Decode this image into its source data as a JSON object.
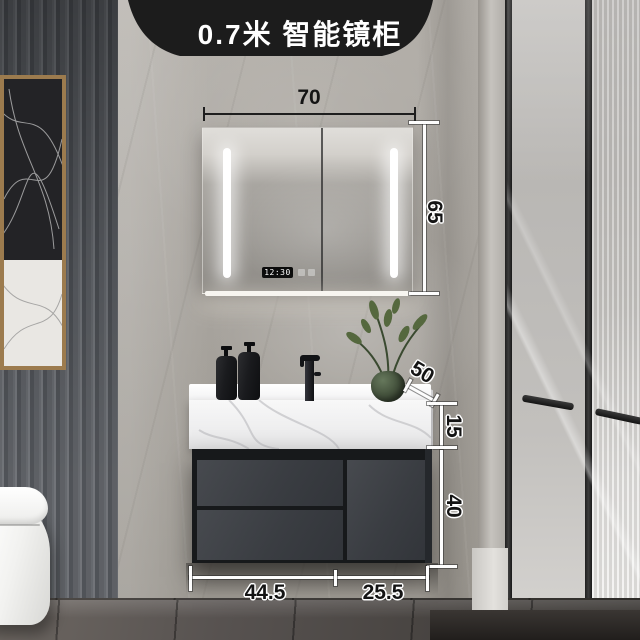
{
  "banner": {
    "title": "0.7米 智能镜柜"
  },
  "dimensions": {
    "mirror_width": "70",
    "mirror_height": "65",
    "counter_depth": "50",
    "counter_rise": "15",
    "cabinet_height": "40",
    "left_section_width": "44.5",
    "right_section_width": "25.5"
  },
  "mirror": {
    "clock_time": "12:30"
  },
  "colors": {
    "banner_bg": "#1c1c1c",
    "banner_text": "#ffffff",
    "annotation_text": "#141414",
    "annotation_outline": "#ffffff",
    "cabinet_panel": "#3c3f43",
    "marble_wall": "#a8a49e",
    "countertop_white": "#f3f3f4",
    "led_white": "#ffffff"
  }
}
